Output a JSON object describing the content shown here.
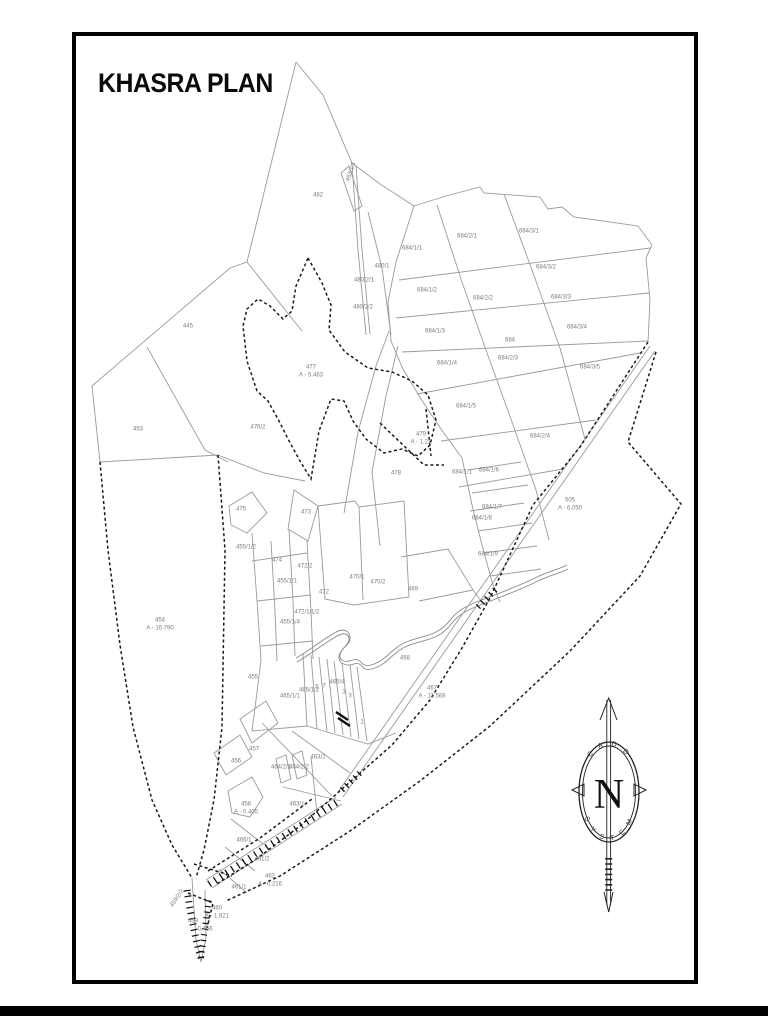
{
  "title": "KHASRA PLAN",
  "colors": {
    "parcel_line": "#9a9a9a",
    "boundary_dashed": "#1a1a1a",
    "stream": "#8a8a8a",
    "label_text": "#7c7c7c",
    "frame": "#000000"
  },
  "compass": {
    "letter": "N",
    "top_text": "C A D D",
    "bottom_text": "S Y S T E M"
  },
  "labels": [
    {
      "t": "482",
      "x": 318,
      "y": 196
    },
    {
      "t": "483/1/1",
      "x": 352,
      "y": 172,
      "r": -72
    },
    {
      "t": "445",
      "x": 188,
      "y": 327
    },
    {
      "t": "453",
      "x": 138,
      "y": 430
    },
    {
      "t": "477\nA - 5.463",
      "x": 311,
      "y": 372
    },
    {
      "t": "476/2",
      "x": 258,
      "y": 428
    },
    {
      "t": "479\nA - 1.21",
      "x": 421,
      "y": 439
    },
    {
      "t": "478",
      "x": 396,
      "y": 474
    },
    {
      "t": "480/1",
      "x": 382,
      "y": 267
    },
    {
      "t": "480/2/1",
      "x": 364,
      "y": 281
    },
    {
      "t": "480/2/2",
      "x": 363,
      "y": 308
    },
    {
      "t": "684/1/1",
      "x": 412,
      "y": 249
    },
    {
      "t": "684/2/1",
      "x": 467,
      "y": 237
    },
    {
      "t": "684/3/1",
      "x": 529,
      "y": 232
    },
    {
      "t": "684/1/2",
      "x": 427,
      "y": 291
    },
    {
      "t": "684/2/2",
      "x": 483,
      "y": 299
    },
    {
      "t": "684/3/2",
      "x": 546,
      "y": 268
    },
    {
      "t": "684/3/3",
      "x": 561,
      "y": 298
    },
    {
      "t": "684/1/3",
      "x": 435,
      "y": 332
    },
    {
      "t": "684",
      "x": 510,
      "y": 341
    },
    {
      "t": "684/2/3",
      "x": 508,
      "y": 359
    },
    {
      "t": "684/3/4",
      "x": 577,
      "y": 328
    },
    {
      "t": "684/1/4",
      "x": 447,
      "y": 364
    },
    {
      "t": "684/3/5",
      "x": 590,
      "y": 368
    },
    {
      "t": "684/1/5",
      "x": 466,
      "y": 407
    },
    {
      "t": "684/2/4",
      "x": 540,
      "y": 437
    },
    {
      "t": "684/1/1",
      "x": 462,
      "y": 473
    },
    {
      "t": "684/1/6",
      "x": 489,
      "y": 471
    },
    {
      "t": "684/1/7",
      "x": 492,
      "y": 508
    },
    {
      "t": "684/1/8",
      "x": 482,
      "y": 519
    },
    {
      "t": "684/1/9",
      "x": 488,
      "y": 555
    },
    {
      "t": "505\nA - 6.050",
      "x": 570,
      "y": 505
    },
    {
      "t": "475",
      "x": 241,
      "y": 510
    },
    {
      "t": "473",
      "x": 306,
      "y": 513
    },
    {
      "t": "455/1/2",
      "x": 246,
      "y": 548
    },
    {
      "t": "474",
      "x": 277,
      "y": 561
    },
    {
      "t": "472/2",
      "x": 305,
      "y": 567
    },
    {
      "t": "455/1/1",
      "x": 287,
      "y": 582
    },
    {
      "t": "470/1",
      "x": 357,
      "y": 578
    },
    {
      "t": "470/2",
      "x": 378,
      "y": 583
    },
    {
      "t": "472",
      "x": 324,
      "y": 593
    },
    {
      "t": "469",
      "x": 413,
      "y": 590
    },
    {
      "t": "472/1/1/2",
      "x": 307,
      "y": 613
    },
    {
      "t": "455/1/4",
      "x": 290,
      "y": 623
    },
    {
      "t": "454\nA - 16.790",
      "x": 160,
      "y": 625
    },
    {
      "t": "455",
      "x": 253,
      "y": 678
    },
    {
      "t": "465/1/2",
      "x": 309,
      "y": 691
    },
    {
      "t": "465/1/1",
      "x": 290,
      "y": 697
    },
    {
      "t": "465/4",
      "x": 337,
      "y": 683
    },
    {
      "t": "5",
      "x": 317,
      "y": 688
    },
    {
      "t": "7",
      "x": 324,
      "y": 687
    },
    {
      "t": "3",
      "x": 344,
      "y": 693
    },
    {
      "t": "3",
      "x": 350,
      "y": 697
    },
    {
      "t": "1",
      "x": 362,
      "y": 723
    },
    {
      "t": "468",
      "x": 405,
      "y": 659
    },
    {
      "t": "467\nA - 11.568",
      "x": 432,
      "y": 693
    },
    {
      "t": "457",
      "x": 254,
      "y": 750
    },
    {
      "t": "456",
      "x": 236,
      "y": 762
    },
    {
      "t": "463/2",
      "x": 318,
      "y": 758
    },
    {
      "t": "464/2/1",
      "x": 281,
      "y": 768
    },
    {
      "t": "464/2/2",
      "x": 299,
      "y": 768
    },
    {
      "t": "463/1",
      "x": 297,
      "y": 805
    },
    {
      "t": "458\nA - 0.405",
      "x": 246,
      "y": 809
    },
    {
      "t": "466/1",
      "x": 244,
      "y": 841
    },
    {
      "t": "461/2",
      "x": 262,
      "y": 860
    },
    {
      "t": "461/1",
      "x": 239,
      "y": 888
    },
    {
      "t": "462\nA - 0.216",
      "x": 270,
      "y": 881
    },
    {
      "t": "459/2/2",
      "x": 178,
      "y": 899,
      "r": -55
    },
    {
      "t": "460\nA - 1.821",
      "x": 217,
      "y": 913
    },
    {
      "t": "459",
      "x": 193,
      "y": 922
    },
    {
      "t": "0.456",
      "x": 205,
      "y": 930
    }
  ]
}
